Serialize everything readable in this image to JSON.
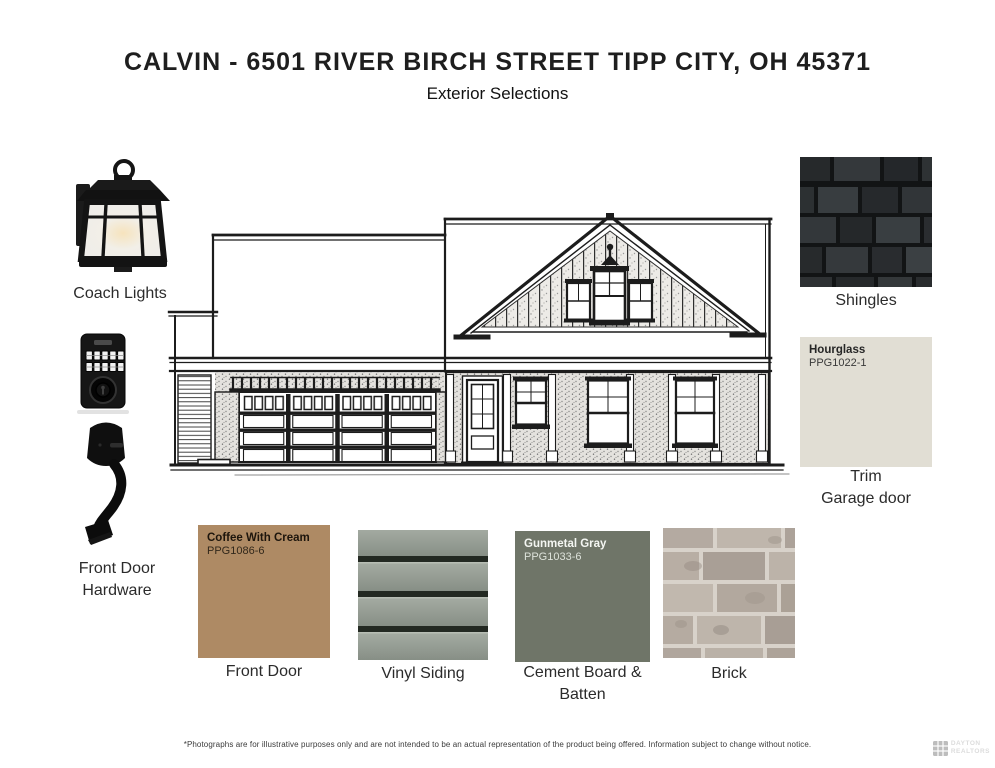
{
  "page": {
    "title": "CALVIN - 6501 RIVER BIRCH STREET TIPP CITY, OH 45371",
    "subtitle": "Exterior Selections",
    "disclaimer": "*Photographs are for illustrative purposes only and are not intended to be an actual representation of the product being offered. Information subject to change without notice.",
    "watermark": {
      "line1": "DAYTON",
      "line2": "REALTORS",
      "icon": "mls-grid-logo"
    }
  },
  "selections": {
    "coach_lights": {
      "label": "Coach Lights"
    },
    "front_door_hardware": {
      "label_line1": "Front Door",
      "label_line2": "Hardware"
    },
    "shingles": {
      "label": "Shingles",
      "color": "#2e3133"
    },
    "trim_garage_door": {
      "paint_name": "Hourglass",
      "paint_code": "PPG1022-1",
      "swatch_color": "#e1ded4",
      "label_line1": "Trim",
      "label_line2": "Garage door"
    },
    "front_door": {
      "paint_name": "Coffee With Cream",
      "paint_code": "PPG1086-6",
      "swatch_color": "#ae8a64",
      "label": "Front Door"
    },
    "vinyl_siding": {
      "label": "Vinyl Siding",
      "color": "#929a91"
    },
    "cement_board_batten": {
      "paint_name": "Gunmetal Gray",
      "paint_code": "PPG1033-6",
      "swatch_color": "#6f7568",
      "label_line1": "Cement Board &",
      "label_line2": "Batten"
    },
    "brick": {
      "label": "Brick",
      "color": "#b4aba1"
    }
  }
}
